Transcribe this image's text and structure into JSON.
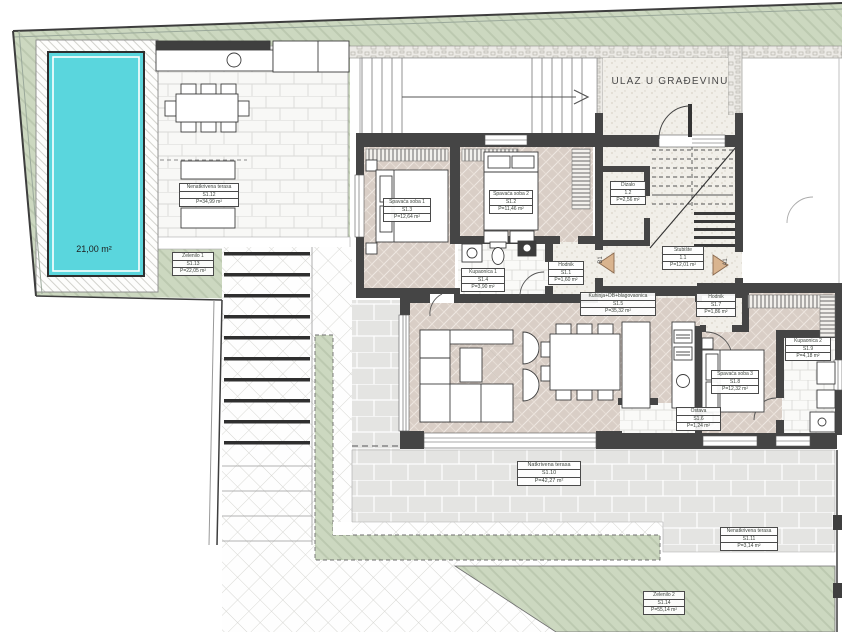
{
  "site": {
    "entrance_text": "ULAZ U GRAĐEVINU",
    "pool": {
      "area_label": "21,00 m²"
    }
  },
  "section_markers": {
    "left": "B1",
    "right": "A1"
  },
  "rooms": [
    {
      "name": "Spavaća soba 1",
      "code": "S1.3",
      "area": "P=12,64 m²"
    },
    {
      "name": "Spavaća soba 2",
      "code": "S1.2",
      "area": "P=11,46 m²"
    },
    {
      "name": "Kupaonica 1",
      "code": "S1.4",
      "area": "P=3,90 m²"
    },
    {
      "name": "Hodnik",
      "code": "S1.1",
      "area": "P=1,60 m²"
    },
    {
      "name": "Dizalo",
      "code": "1.2",
      "area": "P=2,56 m²"
    },
    {
      "name": "Stubište",
      "code": "1.1",
      "area": "P=12,01 m²"
    },
    {
      "name": "Kuhinja+DB+blagovaonica",
      "code": "S1.5",
      "area": "P=35,32 m²"
    },
    {
      "name": "Ostava",
      "code": "S1.6",
      "area": "P=1,24 m²"
    },
    {
      "name": "Hodnik",
      "code": "S1.7",
      "area": "P=1,86 m²"
    },
    {
      "name": "Spavaća soba 3",
      "code": "S1.8",
      "area": "P=12,32 m²"
    },
    {
      "name": "Kupaonica 2",
      "code": "S1.9",
      "area": "P=4,18 m²"
    },
    {
      "name": "Natkrivena terasa",
      "code": "S1.10",
      "area": "P=42,27 m²"
    },
    {
      "name": "Nenatkrivena terasa",
      "code": "S1.11",
      "area": "P=3,14 m²"
    },
    {
      "name": "Nenatkrivena terasa",
      "code": "S1.12",
      "area": "P=34,99 m²"
    },
    {
      "name": "Zelenilo 1",
      "code": "S1.13",
      "area": "P=22,05 m²"
    },
    {
      "name": "Zelenilo 2",
      "code": "S1.14",
      "area": "P=55,14 m²"
    }
  ],
  "colors": {
    "garden_green": "#ccd8c0",
    "pool_cyan": "#5ad6dd",
    "wall_dark": "#454545",
    "floor_beige": "#d9cec6",
    "paver_gray": "#e4e4e2",
    "concrete": "#f1efe9",
    "section_marker_tan": "#d9b48f"
  }
}
